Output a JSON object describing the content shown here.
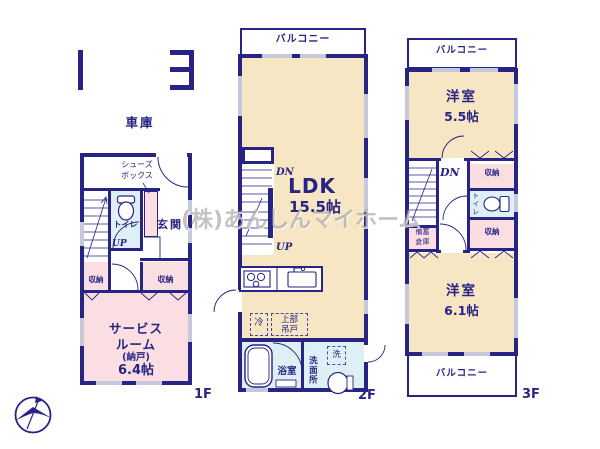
{
  "watermark": "(株)あんしんマイホーム",
  "colors": {
    "wall_navy": "#272484",
    "room_beige": "#f6e6c3",
    "room_pink": "#fadee2",
    "room_blue": "#def0f5",
    "window_gray": "#c6c8dc"
  },
  "floors": {
    "f1": {
      "label": "1F",
      "garage": "車庫",
      "shoes1": "シューズ",
      "shoes2": "ボックス",
      "toilet": "トイレ",
      "entrance": "玄関",
      "up": "UP",
      "closet_l": "収納",
      "closet_r": "収納",
      "service1": "サービス",
      "service2": "ルーム",
      "service3": "(納戸)",
      "service4": "6.4帖"
    },
    "f2": {
      "label": "2F",
      "balcony": "バルコニー",
      "ldk": "LDK",
      "ldk_size": "15.5帖",
      "dn": "DN",
      "up": "UP",
      "fridge": "冷",
      "cab1": "上部",
      "cab2": "吊戸",
      "bath": "浴室",
      "wash": "洗",
      "washroom": "洗面所"
    },
    "f3": {
      "label": "3F",
      "balcony_top": "バルコニー",
      "balcony_bottom": "バルコニー",
      "room1": "洋室",
      "room1_size": "5.5帖",
      "dn": "DN",
      "closet_t": "収納",
      "closet_b": "収納",
      "toilet": "トイレ",
      "stock1": "備蓄",
      "stock2": "倉庫",
      "room2": "洋室",
      "room2_size": "6.1帖"
    }
  }
}
